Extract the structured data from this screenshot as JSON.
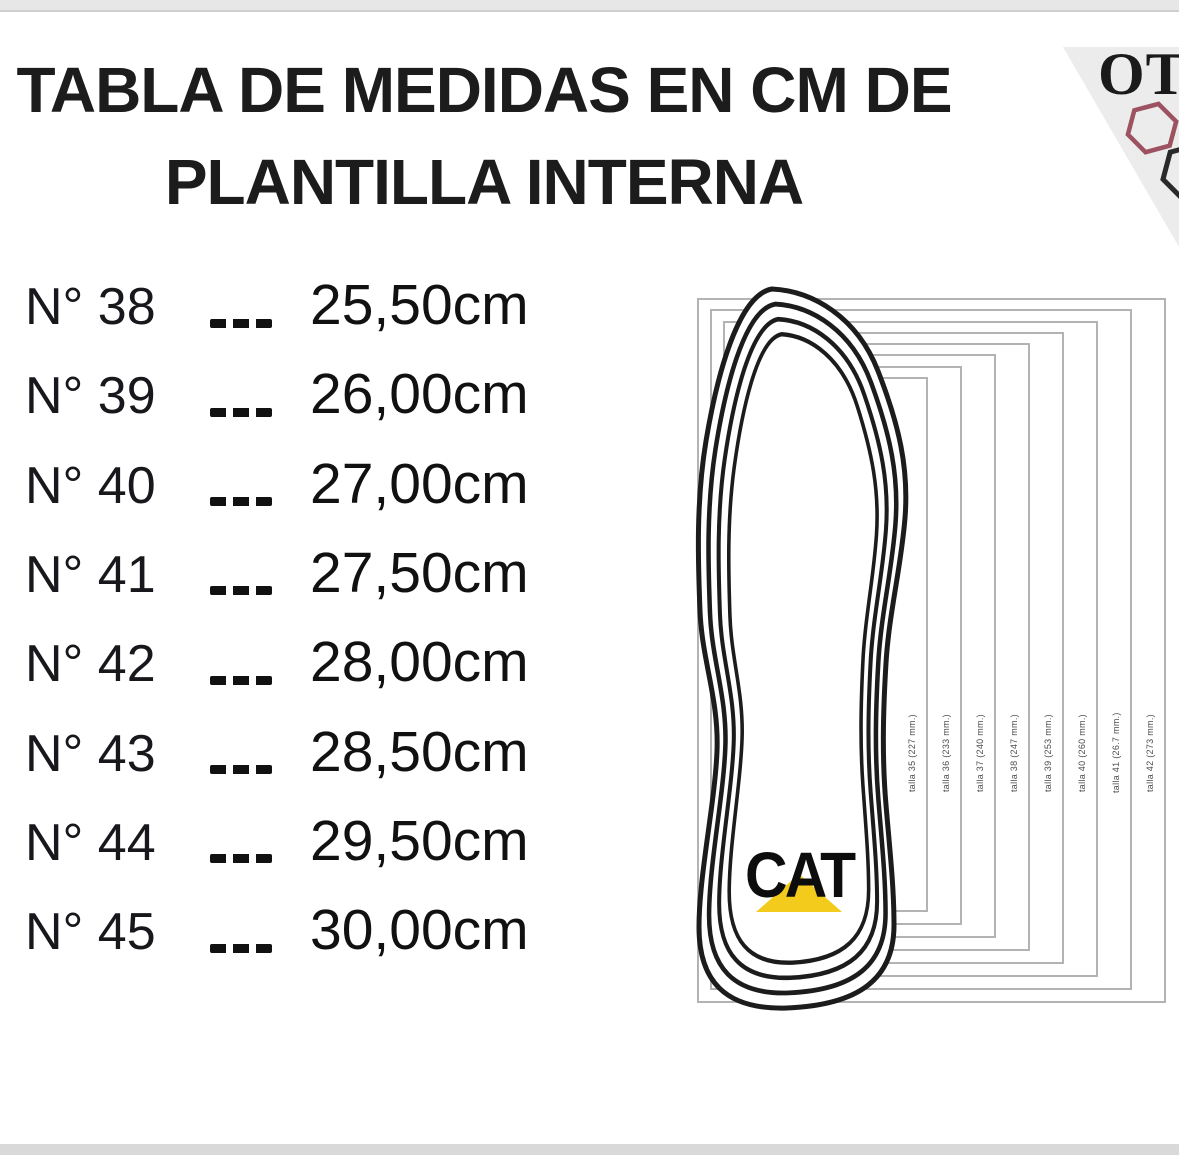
{
  "page": {
    "title_line1": "TABLA DE MEDIDAS EN CM DE",
    "title_line2": "PLANTILLA INTERNA"
  },
  "corner_logo": {
    "text": "OT",
    "hexagon_icon_colors": {
      "upper": "#9c5260",
      "lower": "#2a2a2a"
    },
    "triangle_color": "#ececec"
  },
  "size_table": {
    "separator": "---",
    "rows": [
      {
        "size_label": "N° 38",
        "value": "25,50cm"
      },
      {
        "size_label": "N° 39",
        "value": "26,00cm"
      },
      {
        "size_label": "N° 40",
        "value": "27,00cm"
      },
      {
        "size_label": "N° 41",
        "value": "27,50cm"
      },
      {
        "size_label": "N° 42",
        "value": "28,00cm"
      },
      {
        "size_label": "N° 43",
        "value": "28,50cm"
      },
      {
        "size_label": "N° 44",
        "value": "29,50cm"
      },
      {
        "size_label": "N° 45",
        "value": "30,00cm"
      }
    ]
  },
  "insole_diagram": {
    "brand": "CAT",
    "brand_triangle_color": "#f2cb1d",
    "size_outlines": [
      {
        "label": "talla 35 (227 mm.)"
      },
      {
        "label": "talla 36 (233 mm.)"
      },
      {
        "label": "talla 37 (240 mm.)"
      },
      {
        "label": "talla 38 (247 mm.)"
      },
      {
        "label": "talla 39 (253 mm.)"
      },
      {
        "label": "talla 40 (260 mm.)"
      },
      {
        "label": "talla 41 (26.7 mm.)"
      },
      {
        "label": "talla 42 (273 mm.)"
      }
    ]
  },
  "chart_data": {
    "type": "table",
    "title": "TABLA DE MEDIDAS EN CM DE PLANTILLA INTERNA",
    "columns": [
      "Talla (N°)",
      "Plantilla interna"
    ],
    "rows": [
      [
        "38",
        "25,50cm"
      ],
      [
        "39",
        "26,00cm"
      ],
      [
        "40",
        "27,00cm"
      ],
      [
        "41",
        "27,50cm"
      ],
      [
        "42",
        "28,00cm"
      ],
      [
        "43",
        "28,50cm"
      ],
      [
        "44",
        "29,50cm"
      ],
      [
        "45",
        "30,00cm"
      ]
    ],
    "insole_template_labels_mm": [
      [
        "35",
        "227"
      ],
      [
        "36",
        "233"
      ],
      [
        "37",
        "240"
      ],
      [
        "38",
        "247"
      ],
      [
        "39",
        "253"
      ],
      [
        "40",
        "260"
      ],
      [
        "41",
        "26.7"
      ],
      [
        "42",
        "273"
      ]
    ]
  }
}
